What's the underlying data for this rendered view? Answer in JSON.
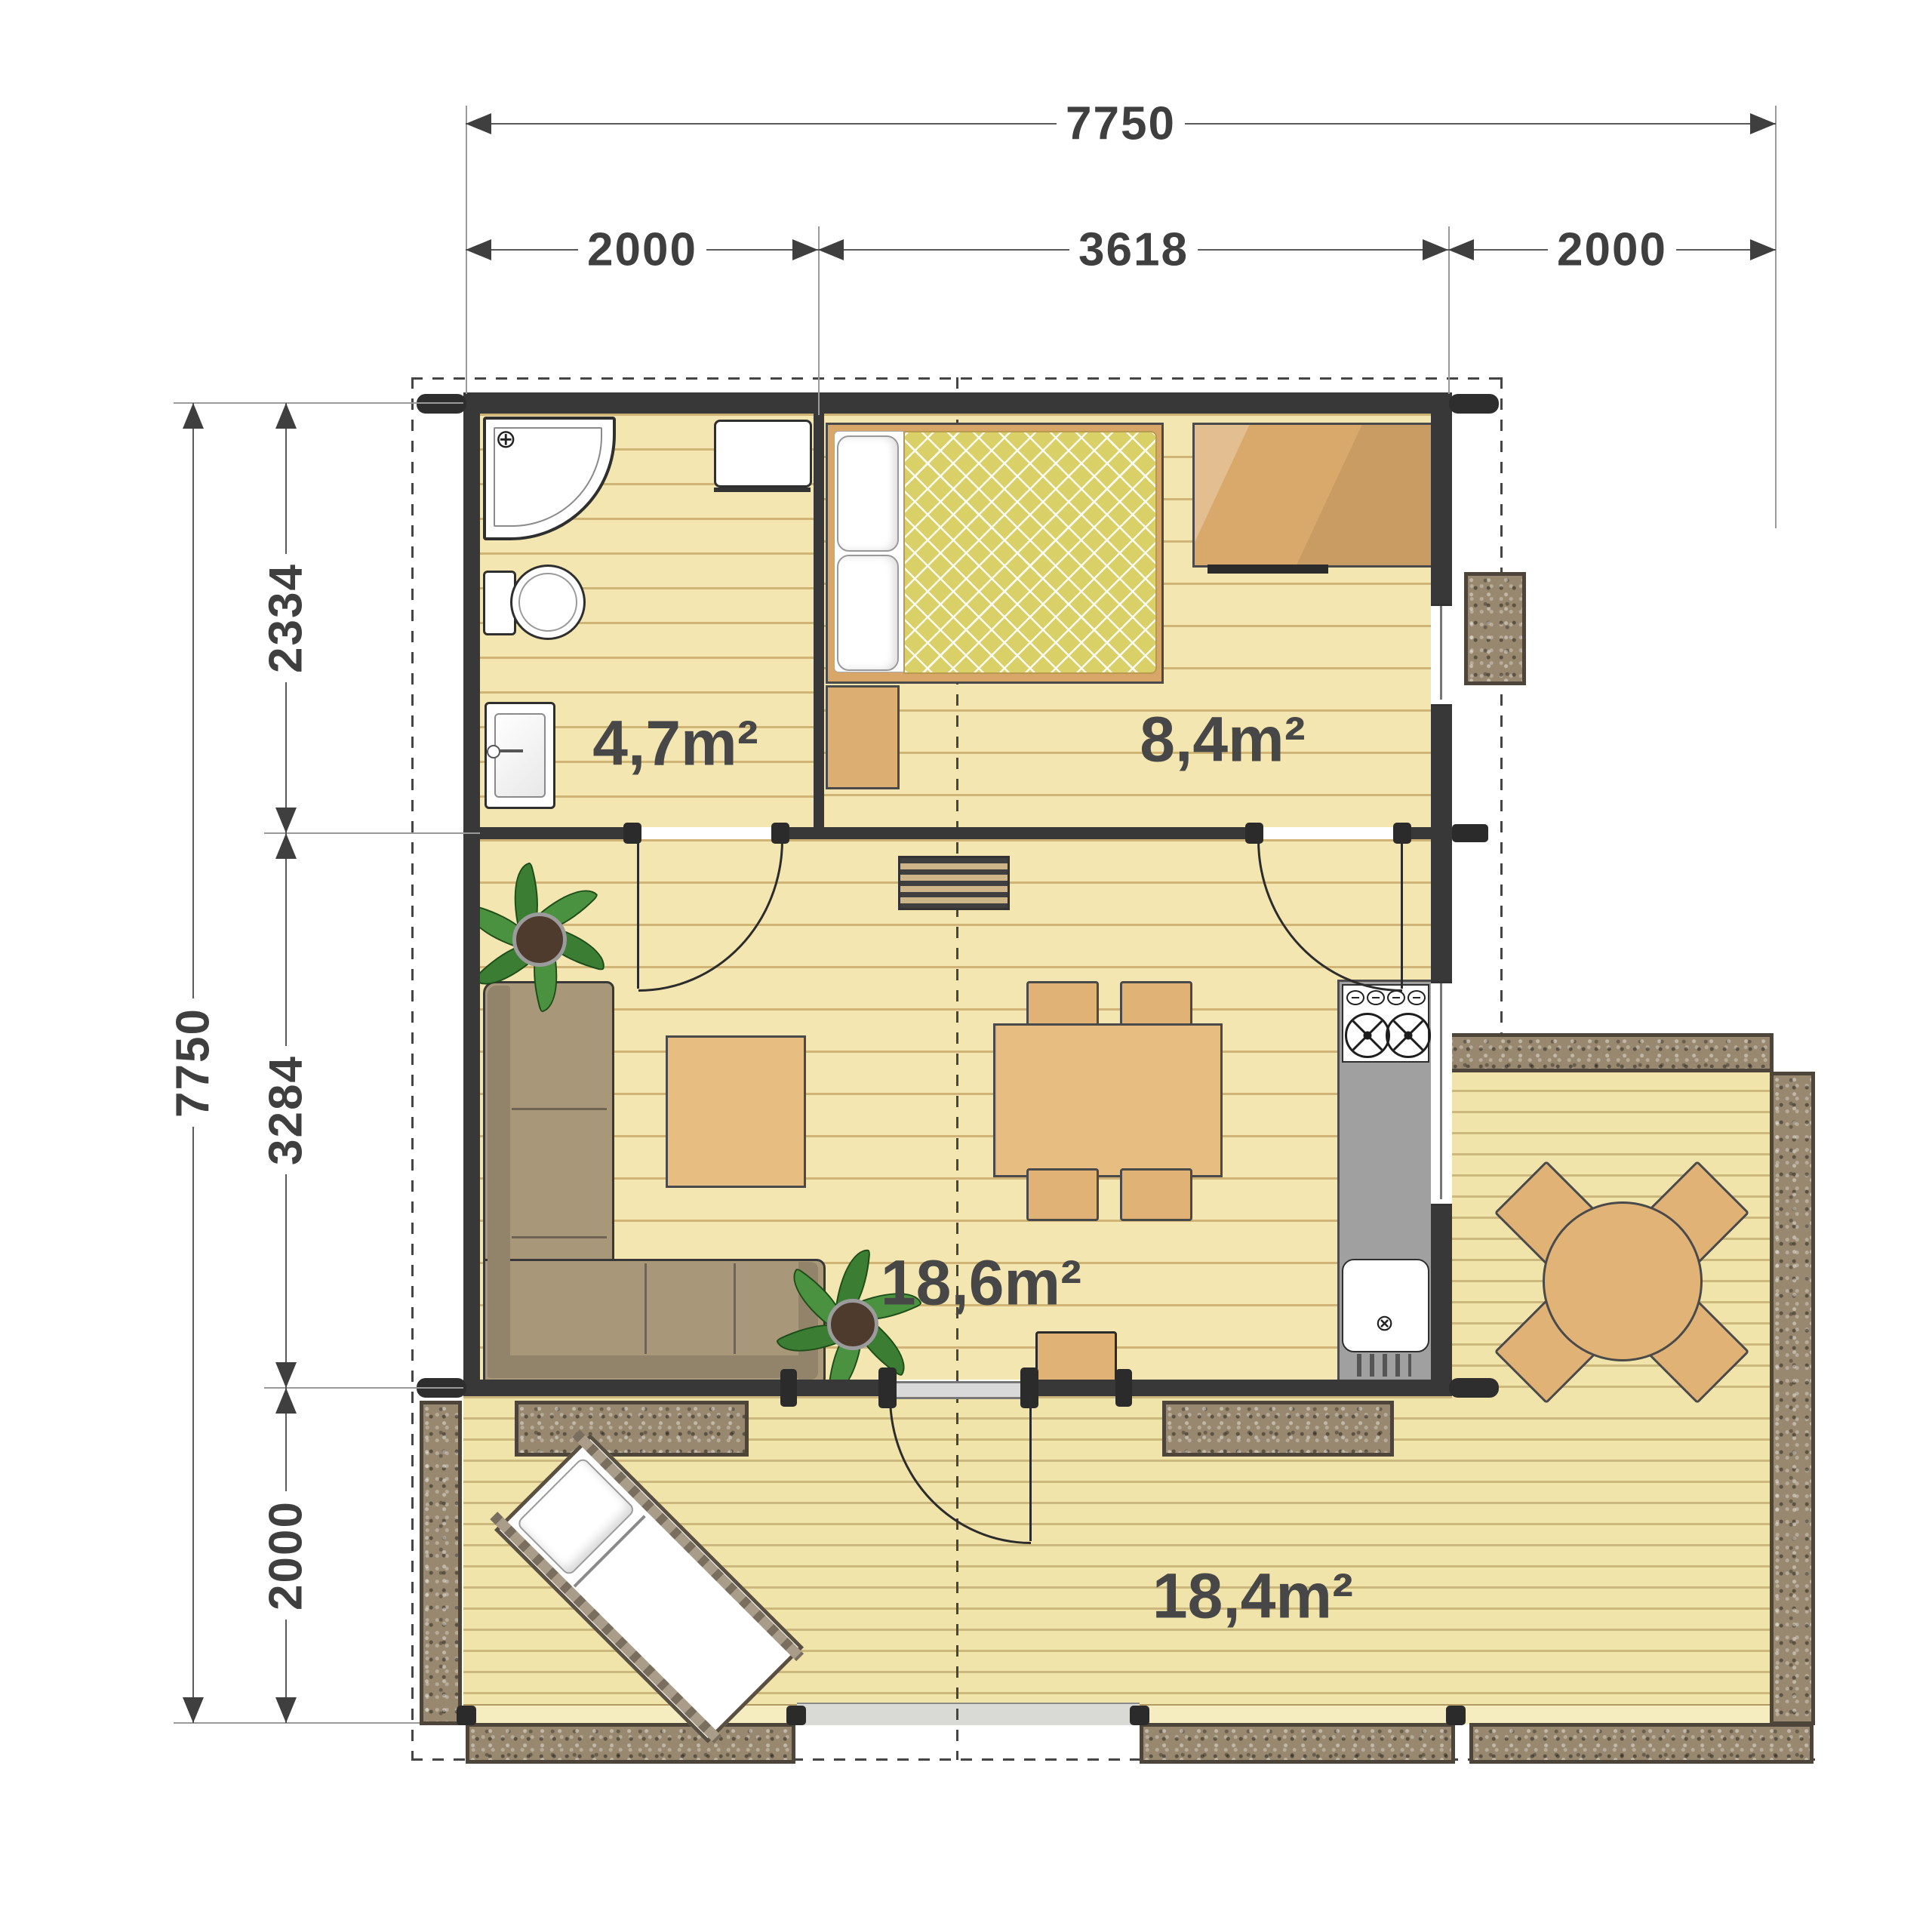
{
  "dimensions": {
    "top": {
      "total": "7750",
      "segments": [
        "2000",
        "3618",
        "2000"
      ]
    },
    "left": {
      "total": "7750",
      "segments": [
        "2334",
        "3284",
        "2000"
      ]
    }
  },
  "rooms": [
    {
      "name": "bathroom",
      "area": "4,7m²"
    },
    {
      "name": "bedroom",
      "area": "8,4m²"
    },
    {
      "name": "living-room",
      "area": "18,6m²"
    },
    {
      "name": "terrace",
      "area": "18,4m²"
    }
  ],
  "icons": {
    "shower_faucet": "⊕",
    "kitchen_sink_drain": "⊗"
  },
  "colors": {
    "wall": "#383838",
    "interior_floor": "#f3e6b0",
    "deck": "#f0e4aa",
    "stone_planter": "#98886f",
    "quilt": "#d9d168",
    "sofa": "#a89879",
    "wood_furniture": "#e7bd82",
    "kitchen_counter": "#a0a0a0",
    "dimension_text": "#3f3f3f",
    "area_text": "#474747",
    "plant": "#3a7d33"
  }
}
